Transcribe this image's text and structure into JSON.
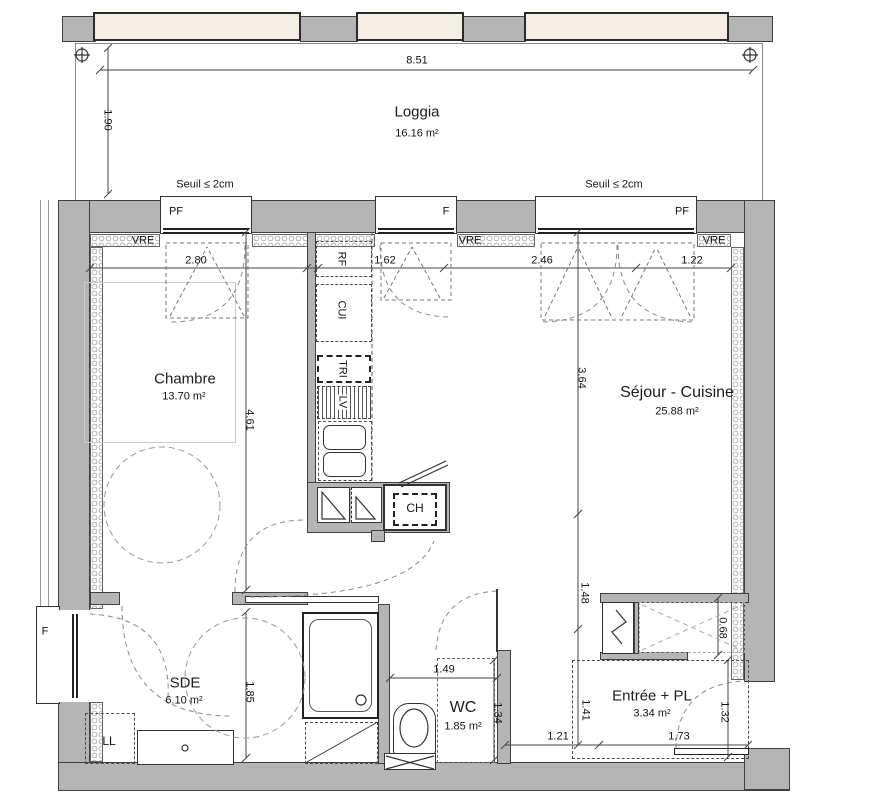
{
  "colors": {
    "wall_fill": "#b5b5b5",
    "panel_fill": "#f2eee3",
    "insulation": "#8d8d8d"
  },
  "loggia": {
    "name": "Loggia",
    "area": "16.16 m²",
    "seuil_left": "Seuil ≤ 2cm",
    "seuil_right": "Seuil ≤ 2cm"
  },
  "rooms": {
    "chambre": {
      "name": "Chambre",
      "area": "13.70 m²"
    },
    "sejour": {
      "name": "Séjour - Cuisine",
      "area": "25.88 m²"
    },
    "sde": {
      "name": "SDE",
      "area": "6.10 m²"
    },
    "wc": {
      "name": "WC",
      "area": "1.85 m²"
    },
    "entree": {
      "name": "Entrée + PL",
      "area": "3.34 m²"
    }
  },
  "windows": {
    "pf1": "PF",
    "f_top": "F",
    "pf2": "PF",
    "f_left": "F",
    "vre1": "VRE",
    "vre2": "VRE",
    "vre3": "VRE"
  },
  "equipment": {
    "rf": "RF",
    "cui": "CUI",
    "tri": "TRI",
    "lv": "LV",
    "ch": "CH",
    "ll": "LL"
  },
  "dims": {
    "top_total": "8.51",
    "loggia_depth": "1.90",
    "chambre_w": "2.80",
    "kitchen_w": "1.62",
    "sejour_w1": "2.46",
    "sejour_w2": "1.22",
    "chambre_h": "4.61",
    "sejour_h": "3.64",
    "sejour_h2": "1.48",
    "sde_h": "1.85",
    "wc_w": "1.49",
    "wc_h": "1.34",
    "entree_h": "1.41",
    "entree_w1": "1.21",
    "entree_w2": "1,73",
    "entree_h2": "1.32",
    "pl_depth": "0.68"
  }
}
